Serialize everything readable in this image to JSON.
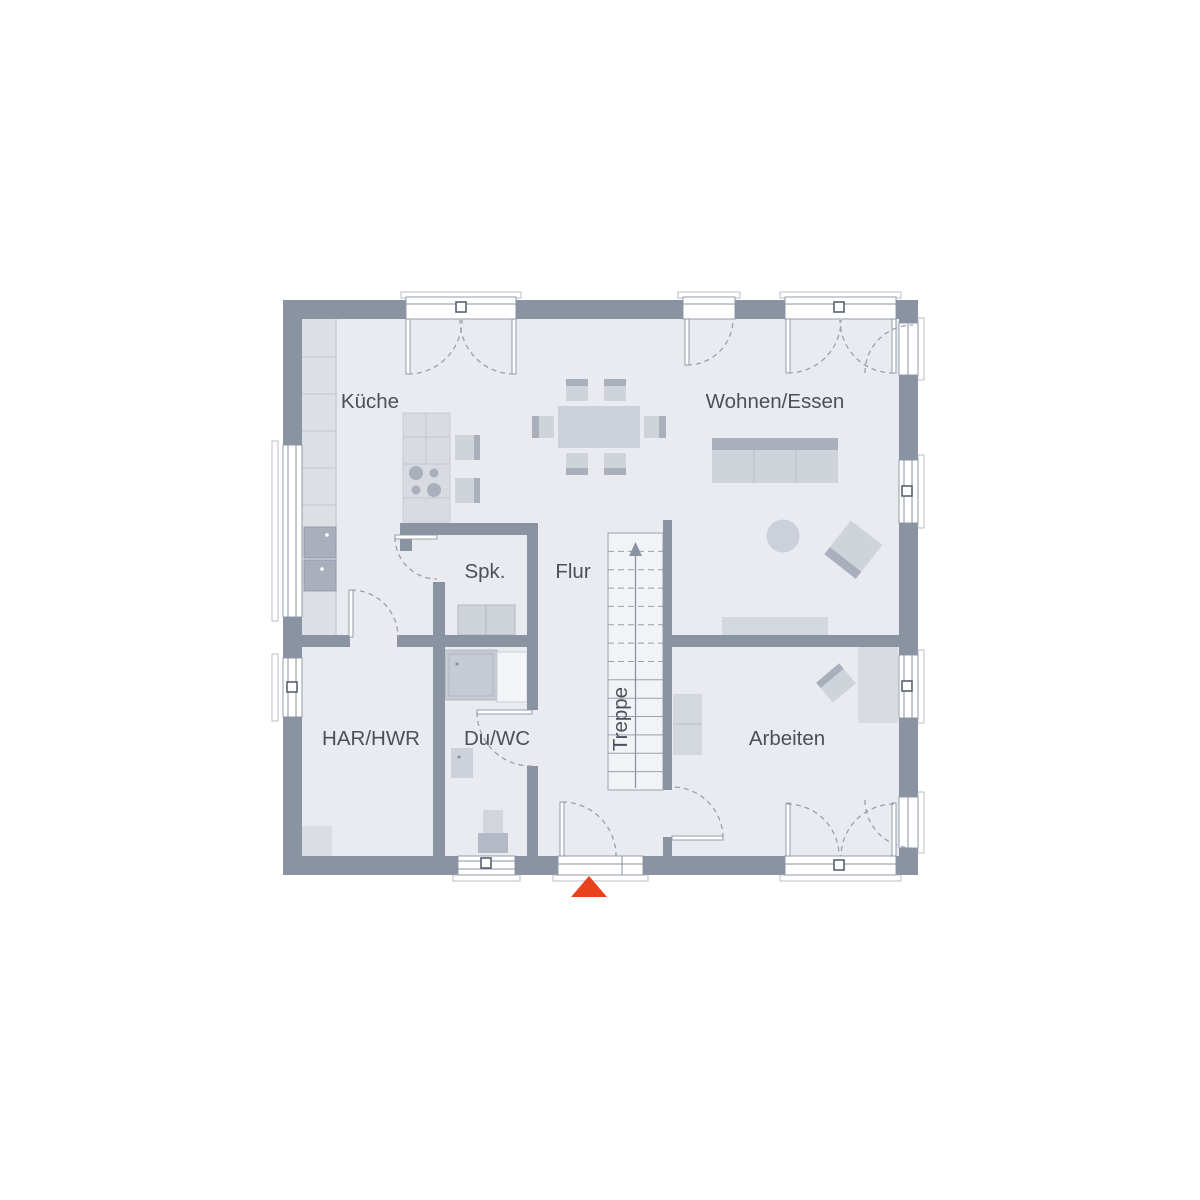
{
  "page": {
    "type": "floor-plan",
    "background": "#ffffff"
  },
  "rooms": {
    "kueche": {
      "label": "Küche"
    },
    "wohnen_essen": {
      "label": "Wohnen/Essen"
    },
    "spk": {
      "label": "Spk."
    },
    "flur": {
      "label": "Flur"
    },
    "treppe": {
      "label": "Treppe"
    },
    "har_hwr": {
      "label": "HAR/HWR"
    },
    "du_wc": {
      "label": "Du/WC"
    },
    "arbeiten": {
      "label": "Arbeiten"
    }
  },
  "markers": {
    "entrance_arrow": {
      "shape": "triangle-up",
      "color": "#e8411b"
    }
  },
  "palette": {
    "wall": "#8a93a2",
    "floor": "#e9ebf0",
    "furniture_light": "#d8dbe1",
    "furniture_mid": "#cfd3da",
    "furniture_dark": "#a9afbb",
    "stairs_fill": "#f1f3f6",
    "line": "#9aa0ac",
    "text": "#4b505a",
    "entrance_marker": "#e8411b"
  }
}
